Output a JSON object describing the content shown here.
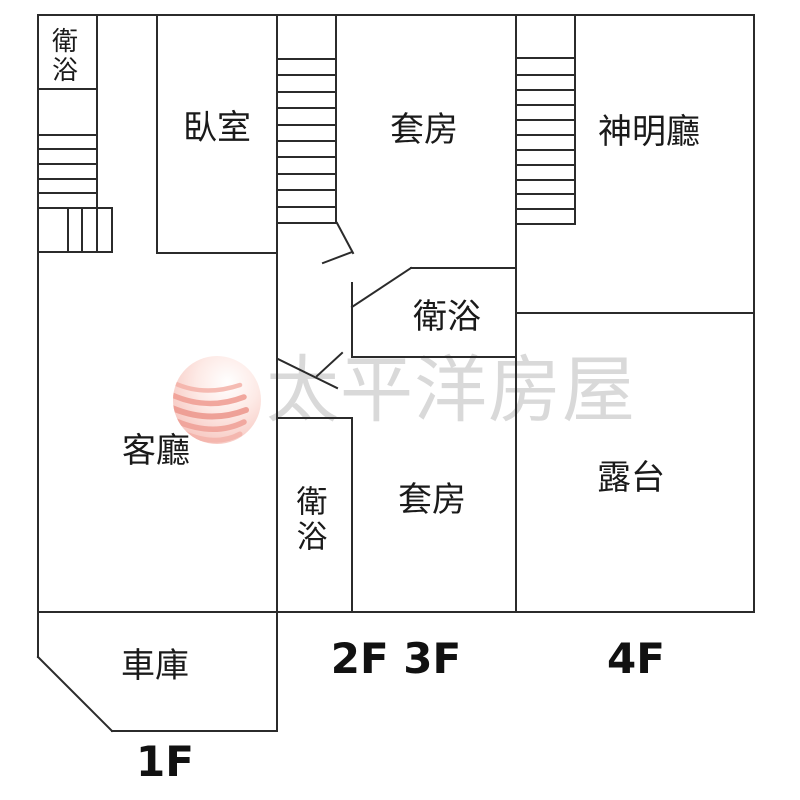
{
  "plan_title": "residential-floor-plan",
  "colors": {
    "wall": "#2b2b2b",
    "label_text": "#1a1a1a",
    "watermark_text": "#d9d9d9",
    "logo_pink_light": "#f6c3bc",
    "logo_pink_wave": "#ec998f",
    "background": "#ffffff"
  },
  "watermark": {
    "text": "太平洋房屋",
    "logo": "pacific-house-sphere-logo"
  },
  "rooms": {
    "bath_top_left": {
      "label": "衛浴"
    },
    "bedroom": {
      "label": "臥室"
    },
    "suite_upper": {
      "label": "套房"
    },
    "shrine_hall": {
      "label": "神明廳"
    },
    "bath_mid": {
      "label": "衛浴"
    },
    "living_room": {
      "label": "客廳"
    },
    "bath_lower": {
      "label": "衛浴"
    },
    "suite_lower": {
      "label": "套房"
    },
    "terrace": {
      "label": "露台"
    },
    "garage": {
      "label": "車庫"
    }
  },
  "floor_labels": {
    "first": {
      "label": "1F"
    },
    "second_third": {
      "label": "2F 3F"
    },
    "fourth": {
      "label": "4F"
    }
  }
}
